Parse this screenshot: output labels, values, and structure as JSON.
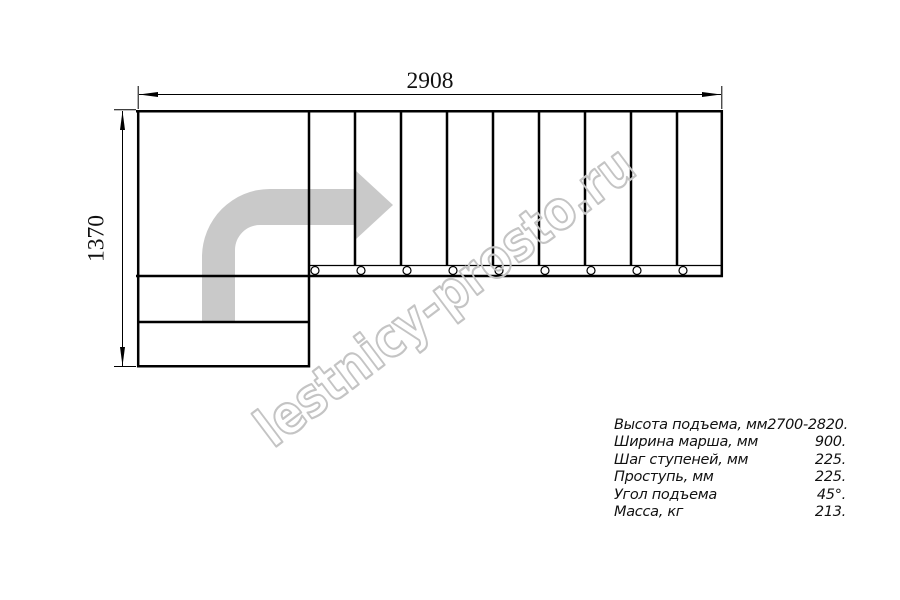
{
  "drawing": {
    "title_hint": "stair-plan-top-view",
    "top_dimension": "2908",
    "left_dimension": "1370",
    "watermark": "lestnicy-prosto.ru",
    "steps_in_flight": 9,
    "colors": {
      "line": "#000000",
      "direction_arrow": "#c9c9c9",
      "watermark": "#c4c4c4",
      "background": "#ffffff"
    }
  },
  "specs": {
    "rows": [
      {
        "label": "Высота подъема, мм",
        "value": "2700-2820."
      },
      {
        "label": "Ширина марша, мм",
        "value": "900."
      },
      {
        "label": "Шаг ступеней, мм",
        "value": "225."
      },
      {
        "label": "Проступь, мм",
        "value": "225."
      },
      {
        "label": "Угол подъема",
        "value": "45°."
      },
      {
        "label": "Масса, кг",
        "value": "213."
      }
    ]
  }
}
